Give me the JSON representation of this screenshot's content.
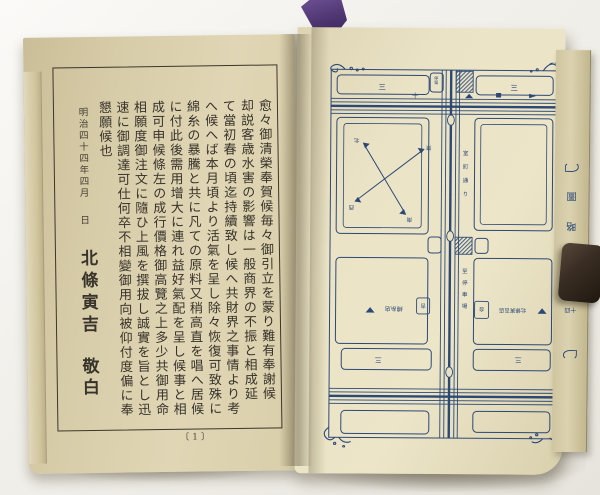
{
  "left_page": {
    "columns": [
      "愈々御清榮奉賀候毎々御引立を蒙り難有奉謝候",
      "却説客歳水害の影響は一般商界の不振と相成延",
      "て當初春の頃迄持續致し候へ共財界之事情より考",
      "へ候へば本月頃より活氣を呈し除々恢復可致殊に",
      "綿糸の暴騰と共に凡ての原料又稍高直を唱へ居候",
      "に付此後需用增大に連れ益好氣配を呈し候事と相",
      "成可申候條左の成行價格御高覽之上多少共御用命",
      "相願度御注文に隨ひ上風を撰拔し誠實を旨とし迅",
      "速に御調達可仕何卒不相變御用向被仰付度偏に奉",
      "懇願候也"
    ],
    "date": "明治四十四年四月",
    "day": "日",
    "signature": "北條寅吉",
    "closing": "敬白",
    "page_number": "〔1〕"
  },
  "right_page": {
    "map": {
      "ink_color": "#2c4976",
      "top_left_block": "三",
      "top_right_block": "三",
      "lower_left_block": "三",
      "lower_right_block": "三",
      "cross_mark": "十",
      "stop_tab": "停留",
      "street_name_upper": "室町通り",
      "street_name_lower": "至停車場",
      "compass": {
        "nw": "北",
        "ne": "東",
        "sw": "西",
        "se": "南"
      },
      "shop_left_box": "吉",
      "shop_left": "綿糸店",
      "shop_right_box": "合",
      "shop_right": "北條寅吉店"
    },
    "edge_strip": [
      "圖",
      "略",
      "近",
      "附"
    ],
    "edge_strip_small": "十四"
  }
}
